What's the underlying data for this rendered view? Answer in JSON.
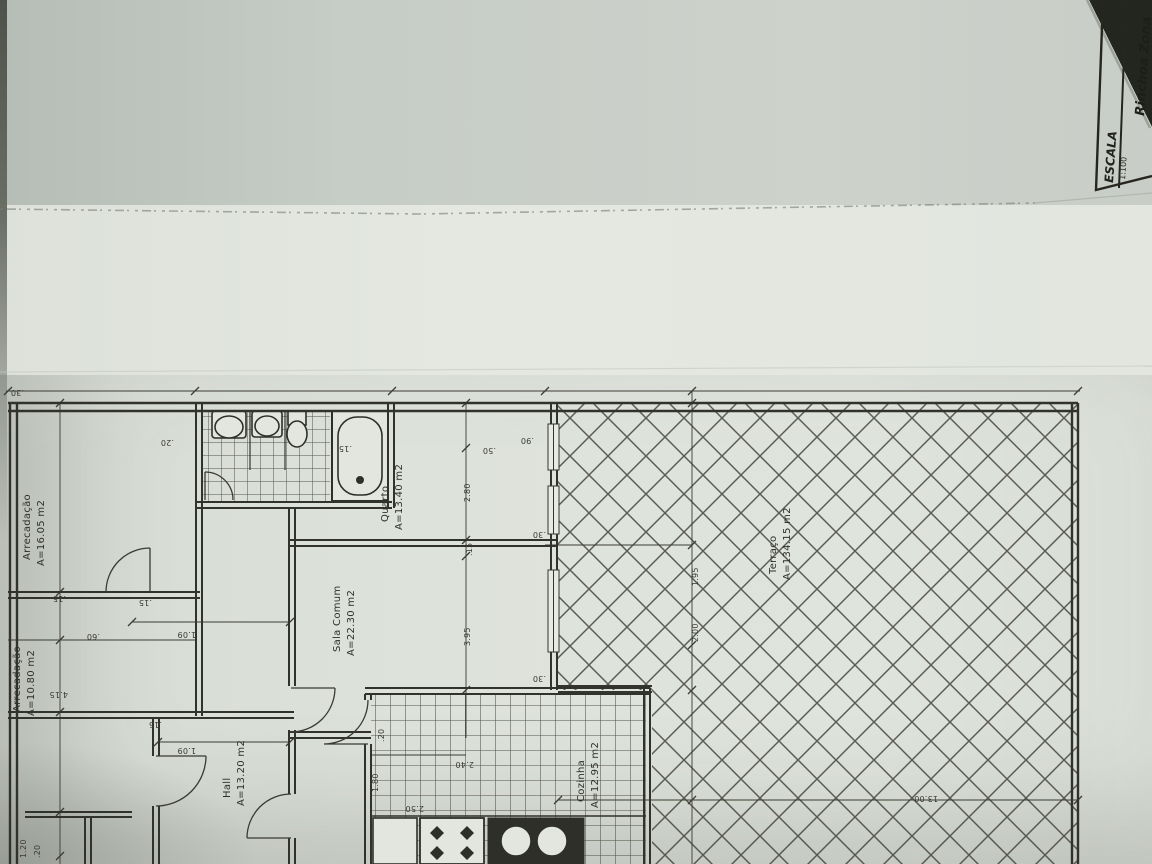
{
  "colors": {
    "paper": "#dde2da",
    "ink": "#34342e",
    "background": "#23251f"
  },
  "title_block": {
    "scale_label": "ESCALA",
    "scale_value": "1:100",
    "location": "Rinchoa Zona"
  },
  "rooms": [
    {
      "name": "Arrecadação",
      "area": "A=16.05 m2"
    },
    {
      "name": "Arrecadação",
      "area": "A=10.80 m2"
    },
    {
      "name": "Quarto",
      "area": "A=13.40 m2"
    },
    {
      "name": "Sala Comum",
      "area": "A=22.30 m2"
    },
    {
      "name": "Hall",
      "area": "A=13.20 m2"
    },
    {
      "name": "Cozinha",
      "area": "A=12.95 m2"
    },
    {
      "name": "Terraço",
      "area": "A=134.15 m2"
    }
  ],
  "dims": [
    ".30",
    ".20",
    ".15",
    ".90",
    ".50",
    "2.80",
    ".15",
    "3.95",
    ".30",
    ".30",
    "2.00",
    "1.95",
    "13.00",
    ".15",
    "1.09",
    ".15",
    "1.09",
    ".60",
    "4.15",
    ".15",
    ".20",
    "1.80",
    "2.50",
    "2.40",
    "1.20",
    ".20"
  ]
}
